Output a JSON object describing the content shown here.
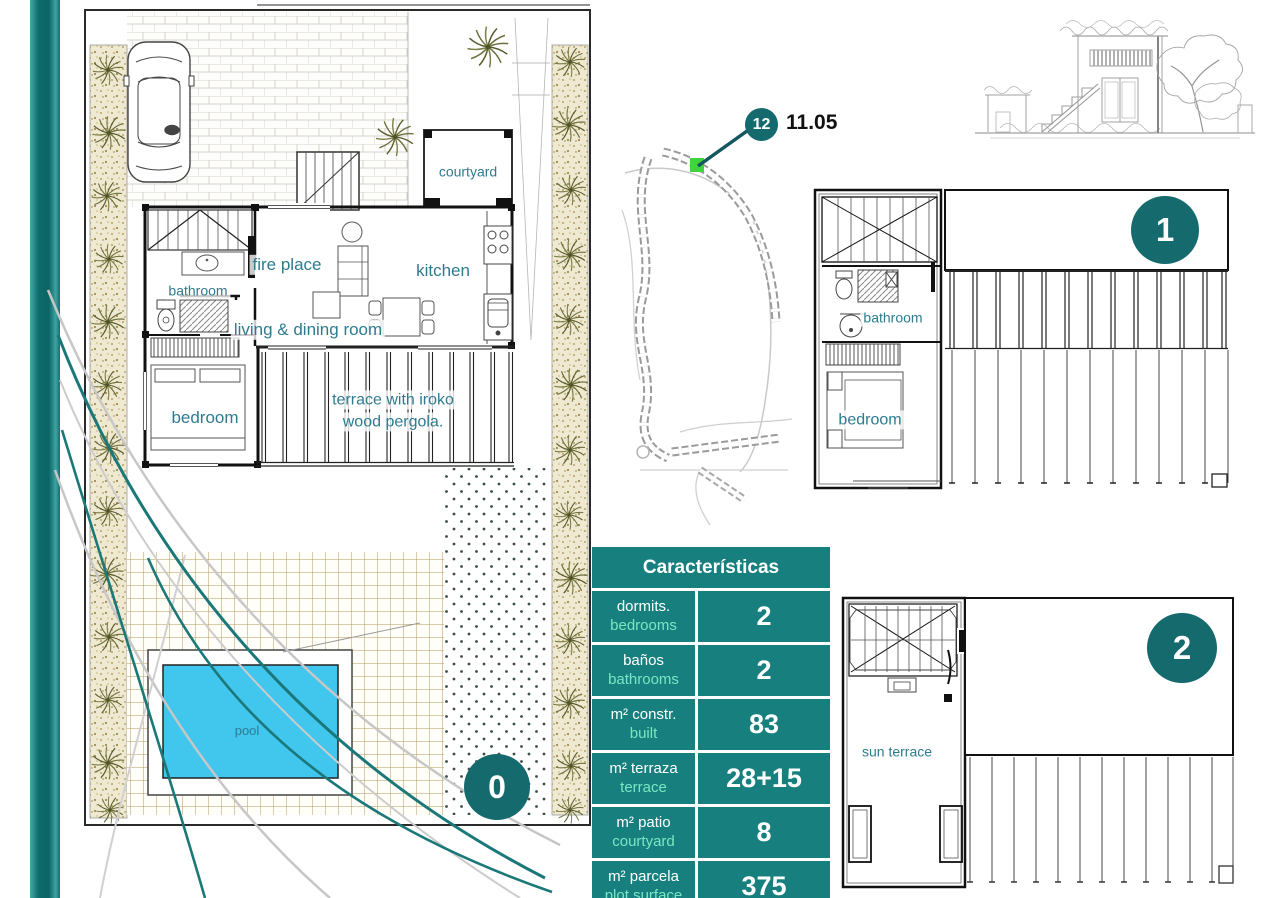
{
  "colors": {
    "teal": "#17807f",
    "badge_teal": "#156a6e",
    "mint": "#7ce6c3",
    "label_teal": "#2e7b8f",
    "pool_blue": "#41c6ee",
    "marker_green": "#3fd43f"
  },
  "site_map": {
    "marker_badge": "12",
    "marker_label": "11.05"
  },
  "floors": {
    "ground": {
      "badge": "0",
      "labels": {
        "courtyard": "courtyard",
        "fire_place": "fire place",
        "bathroom": "bathroom",
        "kitchen": "kitchen",
        "living_dining": "living & dining room",
        "bedroom": "bedroom",
        "terrace_l1": "terrace with iroko",
        "terrace_l2": "wood pergola.",
        "pool": "pool"
      }
    },
    "first": {
      "badge": "1",
      "labels": {
        "bathroom": "bathroom",
        "bedroom": "bedroom"
      }
    },
    "second": {
      "badge": "2",
      "labels": {
        "sun_terrace": "sun terrace"
      }
    }
  },
  "table": {
    "title": "Características",
    "rows": [
      {
        "es": "dormits.",
        "en": "bedrooms",
        "value": "2"
      },
      {
        "es": "baños",
        "en": "bathrooms",
        "value": "2"
      },
      {
        "es": "m² constr.",
        "en": "built",
        "value": "83"
      },
      {
        "es": "m² terraza",
        "en": "terrace",
        "value": "28+15"
      },
      {
        "es": "m² patio",
        "en": "courtyard",
        "value": "8"
      },
      {
        "es": "m² parcela",
        "en": "plot surface",
        "value": "375"
      }
    ]
  }
}
